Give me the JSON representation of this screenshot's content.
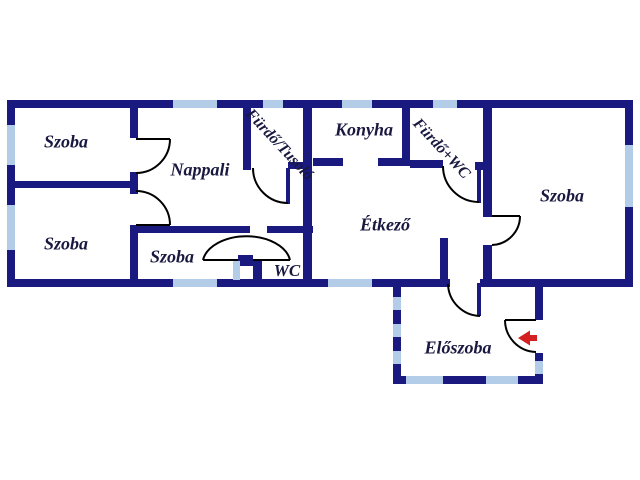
{
  "plan": {
    "type": "floor-plan",
    "language": "Hungarian",
    "rooms": {
      "szoba_top_left": "Szoba",
      "szoba_bottom_left": "Szoba",
      "nappali": "Nappali",
      "szoba_middle": "Szoba",
      "wc": "WC",
      "furdo_tusolo": "Fürdő/Tusoló",
      "konyha": "Konyha",
      "furdo_wc": "Fürdő+WC",
      "etkezo": "Étkező",
      "szoba_right": "Szoba",
      "eloszoba": "Előszoba"
    },
    "entry_arrow": {
      "direction": "left"
    }
  },
  "colors": {
    "wall": "#191980",
    "window": "#b3cce8",
    "label": "#181840",
    "door_arc": "#000000",
    "arrow": "#d42020",
    "bg": "#ffffff"
  }
}
